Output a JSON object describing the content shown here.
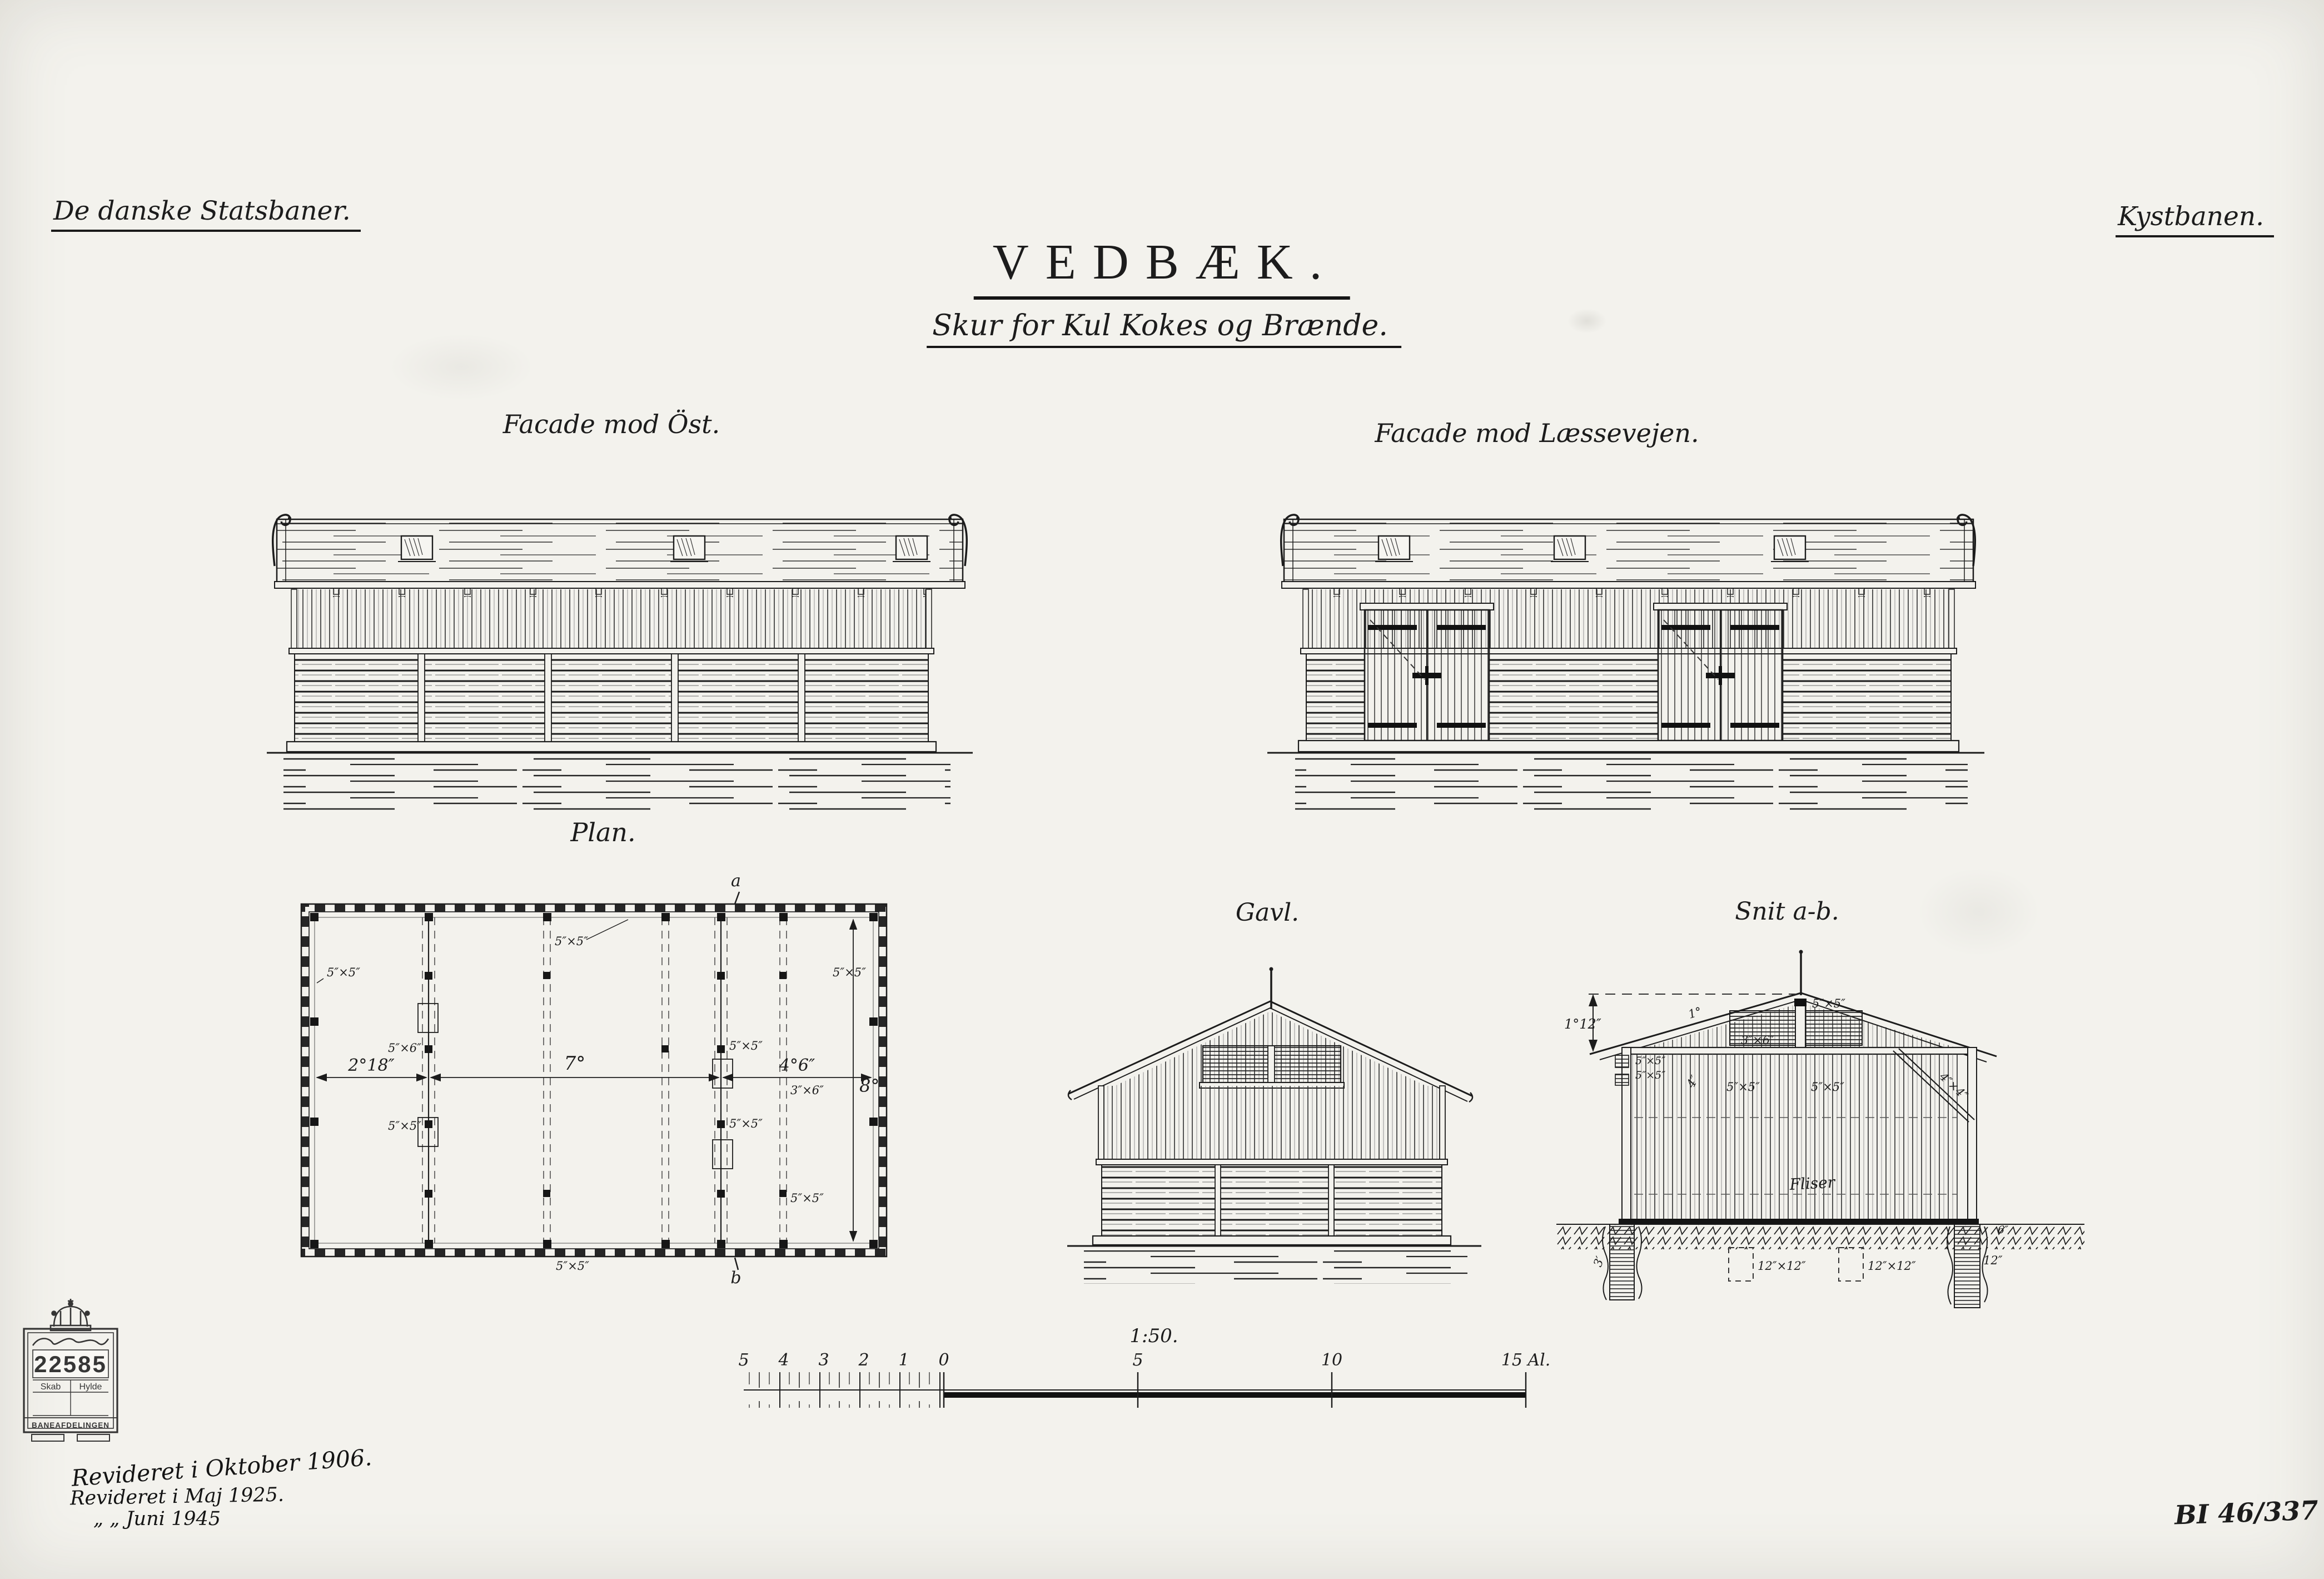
{
  "sheet": {
    "company": "De danske Statsbaner.",
    "railway": "Kystbanen.",
    "title": "VEDBÆK.",
    "subtitle": "Skur for Kul Kokes og Brænde.",
    "doc_number": "BI 46/337"
  },
  "figures": {
    "east": {
      "label": "Facade mod Öst."
    },
    "loading": {
      "label": "Facade mod Læssevejen."
    },
    "plan": {
      "label": "Plan.",
      "marker_top": "a",
      "marker_bottom": "b",
      "dim_left": "2°18″",
      "dim_mid": "7°",
      "dim_right": "4°6″",
      "dim_depth": "8°",
      "post_left": "5″×5″",
      "post_top": "5″×5″",
      "post_right": "5″×5″",
      "post_bottom": "5″×5″",
      "post_mid_upper": "5″×6″",
      "post_mid_lower": "5″×5″",
      "post_c_upper": "5″×5″",
      "post_c_lower": "5″×5″",
      "stud": "3″×6″",
      "post_br": "5″×5″"
    },
    "gable": {
      "label": "Gavl."
    },
    "section": {
      "label": "Snit a-b.",
      "dim_ridge": "1°12″",
      "dim_roof": "1°",
      "post_apex": "5″×5″",
      "post_eave_a": "5″×5″",
      "post_eave_b": "5″×5″",
      "dim_stud": "4″",
      "post_mid_a": "5″×5″",
      "post_mid_b": "5″×5″",
      "tie_beam": "3″×6″",
      "brace": "4″×4″",
      "floor_note": "Fliser",
      "pier_depth": "3′",
      "pier_a": "12″×12″",
      "pier_b": "12″×12″",
      "pier_right": "12″",
      "ground_right": "6″"
    }
  },
  "scalebar": {
    "ratio": "1:50.",
    "left_ticks": [
      "5",
      "4",
      "3",
      "2",
      "1",
      "0"
    ],
    "right_ticks": [
      "5",
      "10",
      "15 Al."
    ]
  },
  "stamp": {
    "number": "22585",
    "col_left": "Skab",
    "col_right": "Hylde",
    "footer": "BANEAFDELINGEN"
  },
  "revisions": {
    "line1": "Revideret i Oktober 1906.",
    "line2": "Revideret i Maj 1925.",
    "line3": "„          „  Juni 1945"
  }
}
